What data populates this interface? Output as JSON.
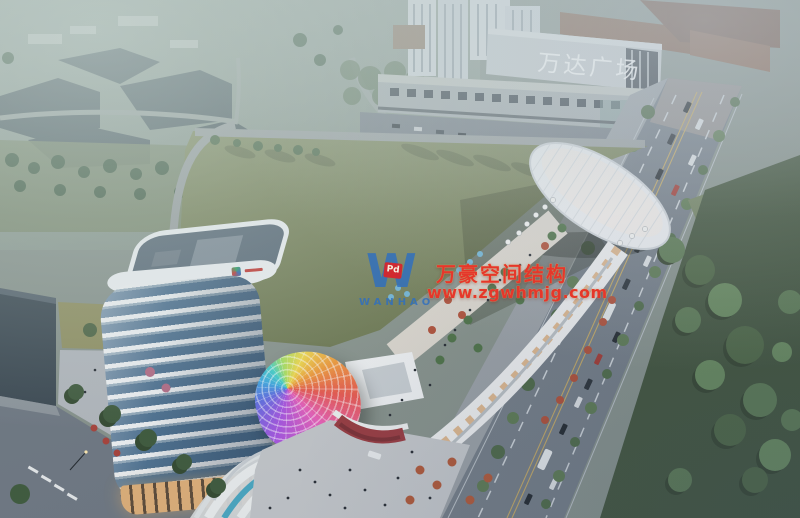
{
  "scene": {
    "wanda_sign": "万达广场"
  },
  "watermark": {
    "logo_letter": "W",
    "badge_text": "Pd",
    "brand": "WANHAO",
    "line1": "万豪空间结构",
    "line2": "www.zgwhmjg.com",
    "red": "#e5372b",
    "blue": "#2f6fc0"
  },
  "palette": {
    "field_green": "#7d8760",
    "park_green": "#42543b",
    "road_gray": "#747d86",
    "tower_glass_blue": "#4f7191",
    "tower_white": "#eceff1",
    "canopy_colors": [
      "#e860b8",
      "#a955e0",
      "#5f6fe0",
      "#3fa8e0",
      "#45d0c8",
      "#a8e060",
      "#f0d84a",
      "#f09a3a",
      "#e85a50"
    ]
  }
}
